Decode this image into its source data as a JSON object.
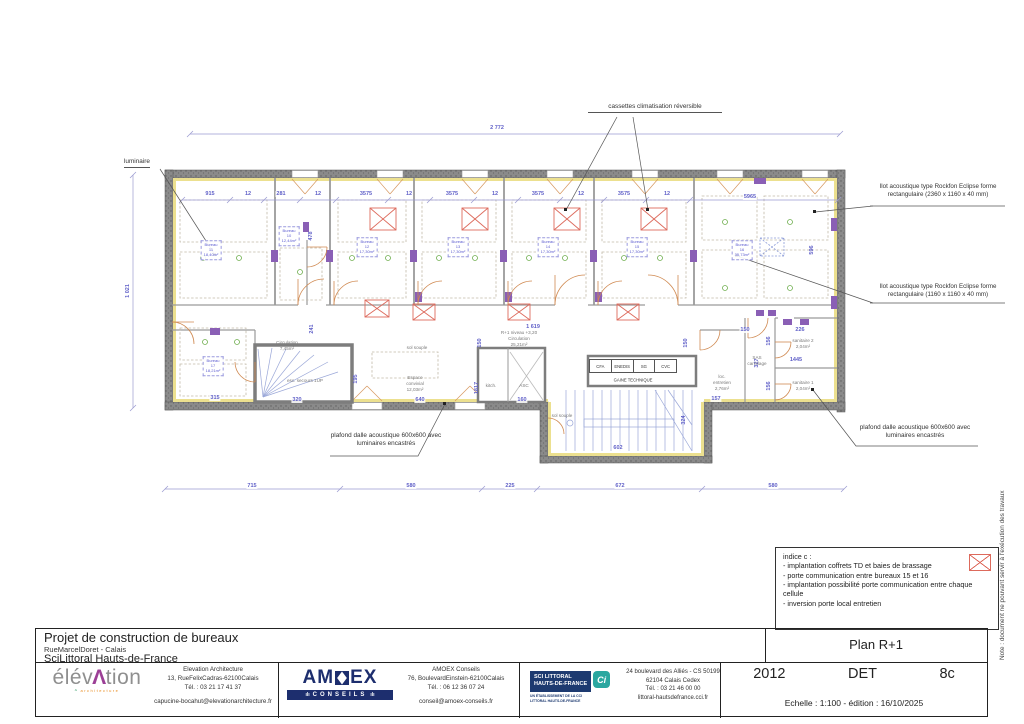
{
  "sheet": {
    "project_title": "Projet de construction de bureaux",
    "project_address": "RueMarcelDoret - Calais",
    "project_client": "SciLittoral Hauts-de-France",
    "plan_title": "Plan R+1",
    "project_number": "2012",
    "phase": "DET",
    "sheet_number": "8c",
    "scale_edition": "Echelle : 1:100 - édition : 16/10/2025",
    "architect": {
      "logo_pre": "élév",
      "logo_a": "Λ",
      "logo_post": "tion",
      "logo_sub": "architecture",
      "name": "Elevation Architecture",
      "address": "13, RueFelixCadras-62100Calais",
      "phone": "Tél. : 03 21 17 41 37",
      "email": "capucine-bocahut@elevationarchitecture.fr"
    },
    "engineer": {
      "logo_pre": "AM",
      "logo_post": "EX",
      "logo_bar": "CONSEILS",
      "name": "AMOEX Conseils",
      "address": "76, BoulevardEinstein-62100Calais",
      "phone": "Tél. : 06 12 36 07 24",
      "email": "conseil@amoex-conseils.fr"
    },
    "client_block": {
      "logo_line1": "SCI LITTORAL",
      "logo_line2": "HAUTS-DE-FRANCE",
      "logo_cci": "Ci",
      "logo_sub1": "UN ÉTABLISSEMENT DE LA CCI",
      "logo_sub2": "LITTORAL HAUTS-DE-FRANCE",
      "address1": "24 boulevard des Alliés - CS 50199",
      "address2": "62104 Calais Cedex",
      "phone": "Tél. : 03 21 46 00 00",
      "web": "littoral-hautsdefrance.cci.fr"
    }
  },
  "side_note": "Note : document ne pouvant servir à l'exécution des travaux",
  "indice": {
    "title": "indice c :",
    "items": [
      "- implantation coffrets TD et baies de brassage",
      "- porte communication entre bureaux 15 et 16",
      "- implantation possibilité porte communication entre chaque cellule",
      "- inversion porte local entretien"
    ]
  },
  "annotations": {
    "luminaire": "luminaire",
    "cassettes": "cassettes climatisation réversible",
    "ilot_1": "Ilot acoustique type Rockfon Eclipse forme rectangulaire (2360 x 1160 x 40 mm)",
    "ilot_2": "Ilot acoustique type Rockfon Eclipse forme rectangulaire (1160 x 1160 x 40 mm)",
    "plafond_left": "plafond dalle acoustique 600x600 avec luminaires encastrés",
    "plafond_right": "plafond dalle acoustique 600x600 avec luminaires encastrés"
  },
  "plan": {
    "room_word": "Bureau",
    "gaine": "GAINE TECHNIQUE",
    "tech_cells": [
      "CFA",
      "ENEDIS",
      "SG",
      "CVC"
    ],
    "rooms": [
      {
        "no": "11",
        "area": "18,40m²",
        "x": 211,
        "y": 250
      },
      {
        "no": "10",
        "area": "12,44m²",
        "x": 289,
        "y": 236
      },
      {
        "no": "12",
        "area": "17,30m²",
        "x": 367,
        "y": 247
      },
      {
        "no": "13",
        "area": "17,30m²",
        "x": 458,
        "y": 247
      },
      {
        "no": "14",
        "area": "17,30m²",
        "x": 548,
        "y": 247
      },
      {
        "no": "15",
        "area": "17,30m²",
        "x": 637,
        "y": 247
      },
      {
        "no": "16",
        "area": "35,73m²",
        "x": 742,
        "y": 250
      },
      {
        "no": "17",
        "area": "18,21m²",
        "x": 213,
        "y": 366
      }
    ],
    "labels": [
      {
        "lines": [
          "Circulation",
          "7,45m²"
        ],
        "x": 287,
        "y": 346
      },
      {
        "lines": [
          "esc. secours 1UP"
        ],
        "x": 305,
        "y": 381
      },
      {
        "lines": [
          "R+1 niveau +3,20",
          "Circulation",
          "25,21m²"
        ],
        "x": 519,
        "y": 339
      },
      {
        "lines": [
          "Espace",
          "convivial",
          "12,03m²"
        ],
        "x": 415,
        "y": 384
      },
      {
        "lines": [
          "kitch."
        ],
        "x": 491,
        "y": 386
      },
      {
        "lines": [
          "ASC"
        ],
        "x": 524,
        "y": 386
      },
      {
        "lines": [
          "loc.",
          "entretien",
          "2,76m²"
        ],
        "x": 722,
        "y": 383
      },
      {
        "lines": [
          "SAS",
          "carrelage"
        ],
        "x": 757,
        "y": 361
      },
      {
        "lines": [
          "sanitaire 2",
          "2,04m²"
        ],
        "x": 803,
        "y": 344
      },
      {
        "lines": [
          "sanitaire 1",
          "2,04m²"
        ],
        "x": 803,
        "y": 386
      },
      {
        "lines": [
          "sol souple"
        ],
        "x": 417,
        "y": 348
      },
      {
        "lines": [
          "sol souple"
        ],
        "x": 562,
        "y": 416
      }
    ],
    "dims": [
      {
        "t": "2 772",
        "x": 497,
        "y": 128
      },
      {
        "t": "1 021",
        "x": 128,
        "y": 291,
        "v": 1
      },
      {
        "t": "915",
        "x": 210,
        "y": 194
      },
      {
        "t": "12",
        "x": 248,
        "y": 194
      },
      {
        "t": "281",
        "x": 281,
        "y": 194
      },
      {
        "t": "12",
        "x": 318,
        "y": 194
      },
      {
        "t": "3575",
        "x": 366,
        "y": 194
      },
      {
        "t": "12",
        "x": 409,
        "y": 194
      },
      {
        "t": "3575",
        "x": 452,
        "y": 194
      },
      {
        "t": "12",
        "x": 495,
        "y": 194
      },
      {
        "t": "3575",
        "x": 538,
        "y": 194
      },
      {
        "t": "12",
        "x": 581,
        "y": 194
      },
      {
        "t": "3575",
        "x": 624,
        "y": 194
      },
      {
        "t": "12",
        "x": 667,
        "y": 194
      },
      {
        "t": "5965",
        "x": 750,
        "y": 197
      },
      {
        "t": "596",
        "x": 812,
        "y": 250,
        "v": 1
      },
      {
        "t": "478",
        "x": 311,
        "y": 236,
        "v": 1
      },
      {
        "t": "1 619",
        "x": 533,
        "y": 327
      },
      {
        "t": "150",
        "x": 480,
        "y": 343,
        "v": 1
      },
      {
        "t": "150",
        "x": 686,
        "y": 343,
        "v": 1
      },
      {
        "t": "1817",
        "x": 477,
        "y": 388,
        "v": 1
      },
      {
        "t": "241",
        "x": 312,
        "y": 329,
        "v": 1
      },
      {
        "t": "195",
        "x": 356,
        "y": 379,
        "v": 1
      },
      {
        "t": "315",
        "x": 215,
        "y": 398
      },
      {
        "t": "320",
        "x": 297,
        "y": 400
      },
      {
        "t": "640",
        "x": 420,
        "y": 400
      },
      {
        "t": "160",
        "x": 522,
        "y": 400
      },
      {
        "t": "602",
        "x": 618,
        "y": 448
      },
      {
        "t": "324",
        "x": 684,
        "y": 420,
        "v": 1
      },
      {
        "t": "150",
        "x": 745,
        "y": 330
      },
      {
        "t": "226",
        "x": 800,
        "y": 330
      },
      {
        "t": "156",
        "x": 769,
        "y": 341,
        "v": 1
      },
      {
        "t": "327",
        "x": 757,
        "y": 363,
        "v": 1
      },
      {
        "t": "1445",
        "x": 796,
        "y": 360
      },
      {
        "t": "156",
        "x": 769,
        "y": 386,
        "v": 1
      },
      {
        "t": "157",
        "x": 716,
        "y": 399
      },
      {
        "t": "715",
        "x": 252,
        "y": 486
      },
      {
        "t": "580",
        "x": 411,
        "y": 486
      },
      {
        "t": "225",
        "x": 510,
        "y": 486
      },
      {
        "t": "672",
        "x": 620,
        "y": 486
      },
      {
        "t": "580",
        "x": 773,
        "y": 486
      }
    ]
  }
}
